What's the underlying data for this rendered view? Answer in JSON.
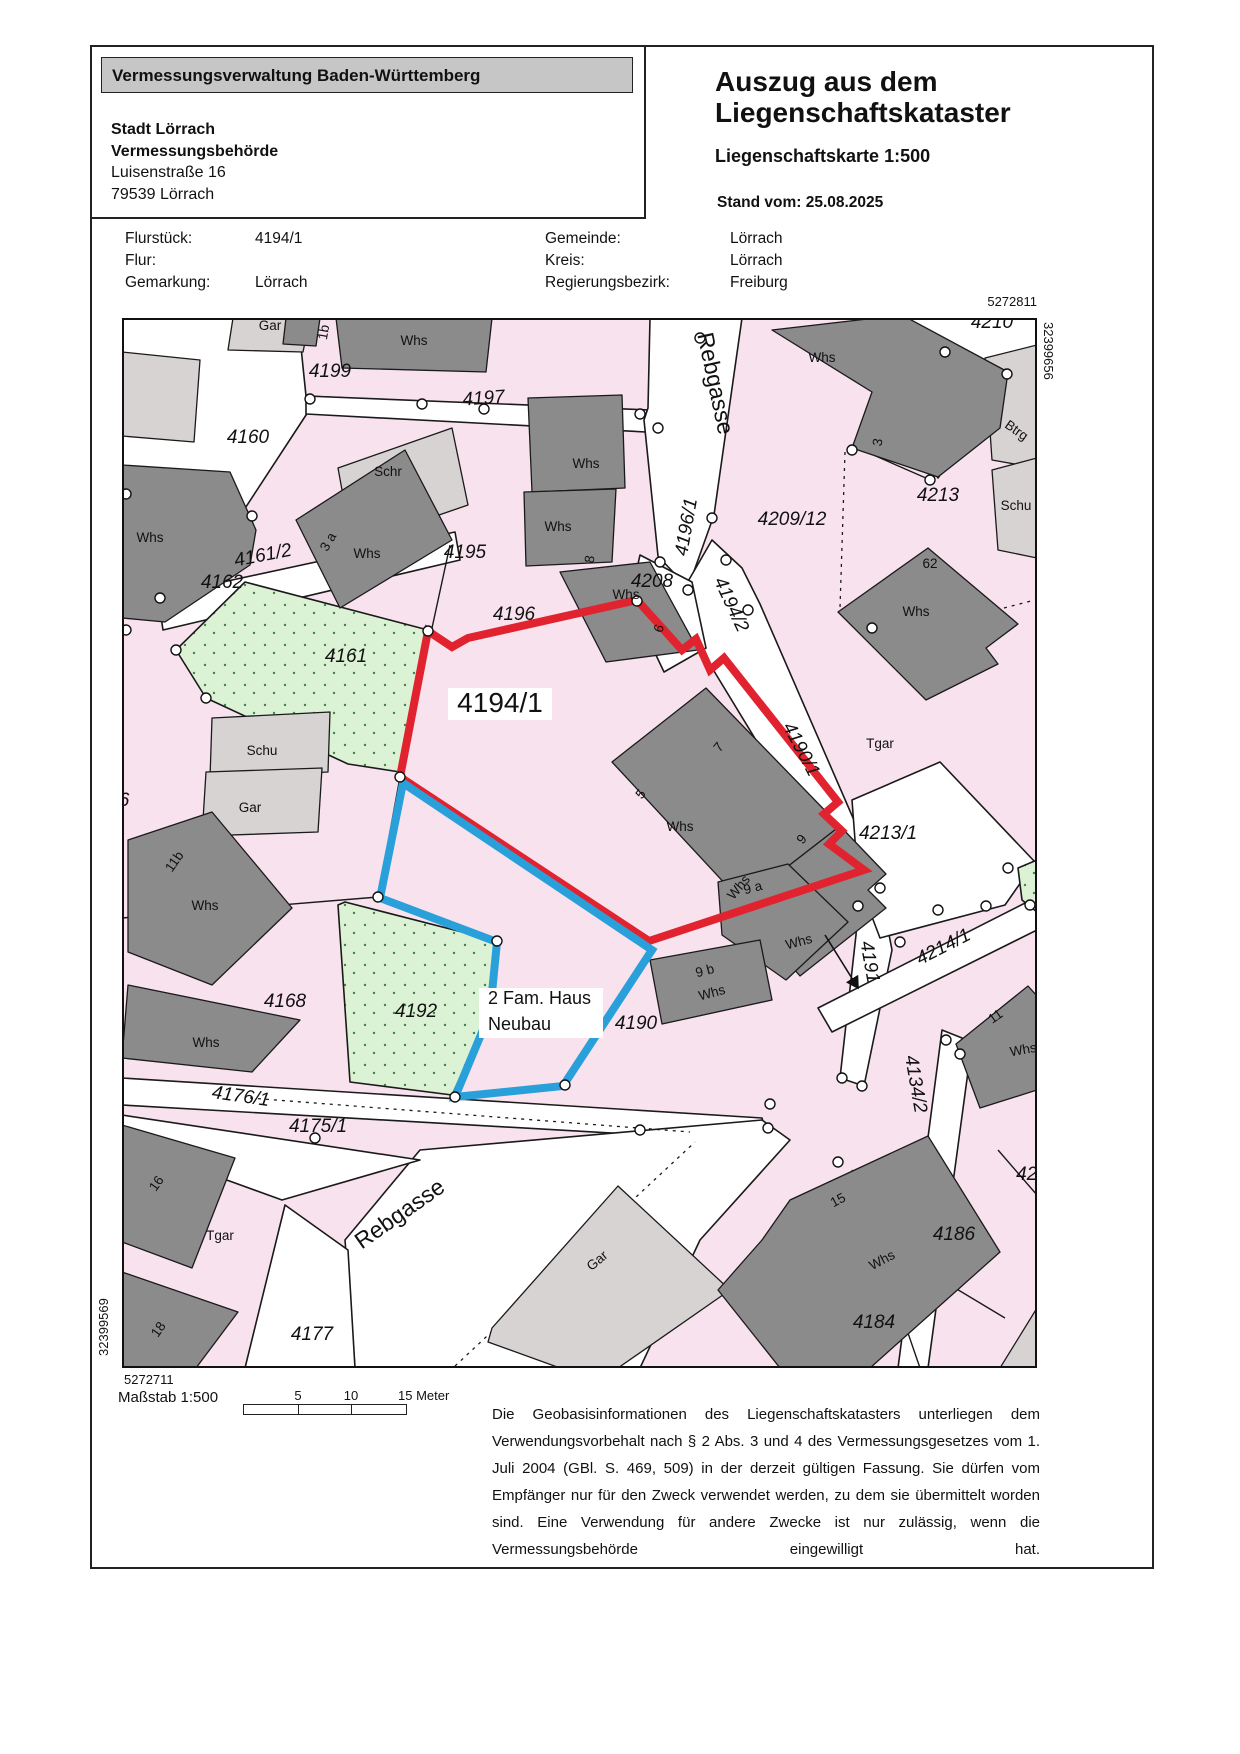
{
  "header": {
    "banner": "Vermessungsverwaltung Baden-Württemberg",
    "office": [
      "Stadt Lörrach",
      "Vermessungsbehörde",
      "Luisenstraße 16",
      "79539 Lörrach"
    ],
    "title1": "Auszug aus dem",
    "title2": "Liegenschaftskataster",
    "subtitle": "Liegenschaftskarte 1:500",
    "stand": "Stand vom: 25.08.2025"
  },
  "info": {
    "left": [
      {
        "label": "Flurstück:",
        "value": "4194/1"
      },
      {
        "label": "Flur:",
        "value": ""
      },
      {
        "label": "Gemarkung:",
        "value": "Lörrach"
      }
    ],
    "right": [
      {
        "label": "Gemeinde:",
        "value": "Lörrach"
      },
      {
        "label": "Kreis:",
        "value": "Lörrach"
      },
      {
        "label": "Regierungsbezirk:",
        "value": "Freiburg"
      }
    ]
  },
  "map": {
    "corners": {
      "top_right_h": "5272811",
      "top_right_v": "32399656",
      "bottom_left_v": "32399569",
      "bottom_left_h": "5272711"
    },
    "colors": {
      "parcel_pink": "#F8E2EE",
      "parcel_green": "#DCF2D4",
      "building_dark": "#8B8B8B",
      "building_light": "#D7D3D3",
      "highlight_red": "#E0232E",
      "highlight_blue": "#2AA0DB"
    },
    "highlight_note": {
      "line1": "2 Fam. Haus",
      "line2": "Neubau"
    },
    "labels": [
      {
        "t": "4199",
        "x": 330,
        "y": 377,
        "cls": "pn"
      },
      {
        "t": "4197",
        "x": 484,
        "y": 404,
        "rot": -4,
        "cls": "pn"
      },
      {
        "t": "4160",
        "x": 248,
        "y": 443,
        "cls": "pn"
      },
      {
        "t": "4161/2",
        "x": 264,
        "y": 561,
        "rot": -11,
        "cls": "pn"
      },
      {
        "t": "4162",
        "x": 222,
        "y": 588,
        "cls": "pn"
      },
      {
        "t": "4161",
        "x": 346,
        "y": 662,
        "cls": "pn"
      },
      {
        "t": "4195",
        "x": 465,
        "y": 558,
        "cls": "pn"
      },
      {
        "t": "4196",
        "x": 514,
        "y": 620,
        "cls": "pn"
      },
      {
        "t": "4208",
        "x": 652,
        "y": 587,
        "cls": "pn"
      },
      {
        "t": "4209/12",
        "x": 792,
        "y": 525,
        "cls": "pn"
      },
      {
        "t": "4213",
        "x": 938,
        "y": 501,
        "cls": "pn"
      },
      {
        "t": "4210",
        "x": 992,
        "y": 328,
        "cls": "pn"
      },
      {
        "t": "4213/1",
        "x": 888,
        "y": 839,
        "cls": "pn"
      },
      {
        "t": "4168",
        "x": 285,
        "y": 1007,
        "cls": "pn"
      },
      {
        "t": "4192",
        "x": 416,
        "y": 1017,
        "cls": "pn"
      },
      {
        "t": "4190",
        "x": 636,
        "y": 1029,
        "cls": "pn"
      },
      {
        "t": "4177",
        "x": 312,
        "y": 1340,
        "cls": "pn"
      },
      {
        "t": "4186",
        "x": 954,
        "y": 1240,
        "cls": "pn"
      },
      {
        "t": "4184",
        "x": 874,
        "y": 1328,
        "cls": "pn"
      },
      {
        "t": "421",
        "x": 1032,
        "y": 1180,
        "cls": "pn"
      },
      {
        "t": "4175/1",
        "x": 318,
        "y": 1132,
        "cls": "pn"
      },
      {
        "t": "6",
        "x": 124,
        "y": 806,
        "cls": "pn"
      },
      {
        "t": "4194/1",
        "x": 500,
        "y": 712,
        "cls": "pn-big"
      },
      {
        "t": "4196/1",
        "x": 692,
        "y": 528,
        "rot": -80,
        "cls": "pn"
      },
      {
        "t": "4194/2",
        "x": 726,
        "y": 607,
        "rot": 65,
        "cls": "pn"
      },
      {
        "t": "4190/1",
        "x": 796,
        "y": 752,
        "rot": 62,
        "cls": "pn"
      },
      {
        "t": "4191",
        "x": 864,
        "y": 963,
        "rot": 80,
        "cls": "pn"
      },
      {
        "t": "4214/1",
        "x": 946,
        "y": 952,
        "rot": -27,
        "cls": "pn"
      },
      {
        "t": "4134/2",
        "x": 910,
        "y": 1085,
        "rot": 80,
        "cls": "pn"
      },
      {
        "t": "4176/1",
        "x": 240,
        "y": 1102,
        "rot": 8,
        "cls": "pn"
      },
      {
        "t": "Rebgasse",
        "x": 708,
        "y": 385,
        "rot": 78,
        "cls": "st"
      },
      {
        "t": "Rebgasse",
        "x": 404,
        "y": 1220,
        "rot": -35,
        "cls": "st"
      },
      {
        "t": "Gar",
        "x": 270,
        "y": 330,
        "cls": "bl"
      },
      {
        "t": "1b",
        "x": 328,
        "y": 333,
        "rot": -80,
        "cls": "bl",
        "size": 12
      },
      {
        "t": "Whs",
        "x": 414,
        "y": 345,
        "cls": "bl"
      },
      {
        "t": "Whs",
        "x": 822,
        "y": 362,
        "cls": "bl"
      },
      {
        "t": "3",
        "x": 882,
        "y": 443,
        "rot": -80,
        "cls": "bl",
        "size": 12
      },
      {
        "t": "Btrg",
        "x": 1014,
        "y": 434,
        "rot": 35,
        "cls": "bl"
      },
      {
        "t": "Schu",
        "x": 1016,
        "y": 510,
        "cls": "bl"
      },
      {
        "t": "62",
        "x": 930,
        "y": 568,
        "cls": "bl",
        "size": 12
      },
      {
        "t": "Whs",
        "x": 916,
        "y": 616,
        "cls": "bl"
      },
      {
        "t": "Schr",
        "x": 388,
        "y": 476,
        "cls": "bl"
      },
      {
        "t": "3 a",
        "x": 332,
        "y": 544,
        "rot": -60,
        "cls": "bl",
        "size": 12
      },
      {
        "t": "Whs",
        "x": 367,
        "y": 558,
        "cls": "bl"
      },
      {
        "t": "Whs",
        "x": 150,
        "y": 542,
        "cls": "bl"
      },
      {
        "t": "Whs",
        "x": 586,
        "y": 468,
        "cls": "bl"
      },
      {
        "t": "Whs",
        "x": 558,
        "y": 531,
        "cls": "bl"
      },
      {
        "t": "8",
        "x": 594,
        "y": 560,
        "rot": -80,
        "cls": "bl",
        "size": 12
      },
      {
        "t": "Whs",
        "x": 626,
        "y": 599,
        "cls": "bl"
      },
      {
        "t": "6",
        "x": 663,
        "y": 630,
        "rot": -70,
        "cls": "bl",
        "size": 12
      },
      {
        "t": "7",
        "x": 722,
        "y": 750,
        "rot": -50,
        "cls": "bl",
        "size": 12
      },
      {
        "t": "5",
        "x": 644,
        "y": 797,
        "rot": -50,
        "cls": "bl",
        "size": 12
      },
      {
        "t": "Whs",
        "x": 680,
        "y": 831,
        "cls": "bl"
      },
      {
        "t": "9",
        "x": 805,
        "y": 842,
        "rot": -50,
        "cls": "bl",
        "size": 12
      },
      {
        "t": "Whs",
        "x": 742,
        "y": 890,
        "rot": -50,
        "cls": "bl"
      },
      {
        "t": "Tgar",
        "x": 880,
        "y": 748,
        "cls": "bl"
      },
      {
        "t": "Schu",
        "x": 262,
        "y": 755,
        "cls": "bl"
      },
      {
        "t": "Gar",
        "x": 250,
        "y": 812,
        "cls": "bl"
      },
      {
        "t": "11b",
        "x": 178,
        "y": 864,
        "rot": -55,
        "cls": "bl",
        "size": 12
      },
      {
        "t": "Whs",
        "x": 205,
        "y": 910,
        "cls": "bl"
      },
      {
        "t": "9 a",
        "x": 754,
        "y": 892,
        "rot": -15,
        "cls": "bl",
        "size": 12
      },
      {
        "t": "Whs",
        "x": 800,
        "y": 946,
        "rot": -15,
        "cls": "bl"
      },
      {
        "t": "9 b",
        "x": 706,
        "y": 975,
        "rot": -15,
        "cls": "bl",
        "size": 12
      },
      {
        "t": "Whs",
        "x": 713,
        "y": 997,
        "rot": -15,
        "cls": "bl"
      },
      {
        "t": "Whs",
        "x": 206,
        "y": 1047,
        "cls": "bl"
      },
      {
        "t": "16",
        "x": 160,
        "y": 1186,
        "rot": -55,
        "cls": "bl",
        "size": 12
      },
      {
        "t": "Tgar",
        "x": 220,
        "y": 1240,
        "cls": "bl"
      },
      {
        "t": "18",
        "x": 162,
        "y": 1332,
        "rot": -55,
        "cls": "bl",
        "size": 12
      },
      {
        "t": "15",
        "x": 840,
        "y": 1204,
        "rot": -28,
        "cls": "bl",
        "size": 12
      },
      {
        "t": "Whs",
        "x": 884,
        "y": 1264,
        "rot": -28,
        "cls": "bl"
      },
      {
        "t": "11",
        "x": 998,
        "y": 1020,
        "rot": -35,
        "cls": "bl",
        "size": 12
      },
      {
        "t": "Whs",
        "x": 1024,
        "y": 1054,
        "rot": -10,
        "cls": "bl"
      },
      {
        "t": "Gar",
        "x": 600,
        "y": 1264,
        "rot": -40,
        "cls": "bl"
      },
      {
        "t": "2 Fam. Haus",
        "x": 488,
        "y": 1004,
        "cls": "note"
      },
      {
        "t": "Neubau",
        "x": 488,
        "y": 1030,
        "cls": "note"
      }
    ]
  },
  "footer": {
    "scale_label": "Maßstab 1:500",
    "scale_ticks": [
      "5",
      "10",
      "15 Meter"
    ],
    "disclaimer": "Die Geobasisinformationen des Liegenschaftskatasters unterliegen dem Verwendungsvorbehalt nach § 2 Abs. 3 und 4 des Vermessungsgesetzes vom 1. Juli 2004 (GBl. S. 469, 509) in der derzeit gültigen Fassung. Sie dürfen vom Empfänger nur für den Zweck verwendet werden, zu dem sie übermittelt worden sind. Eine Verwendung für andere Zwecke ist nur zulässig, wenn die Vermessungsbehörde eingewilligt hat."
  }
}
